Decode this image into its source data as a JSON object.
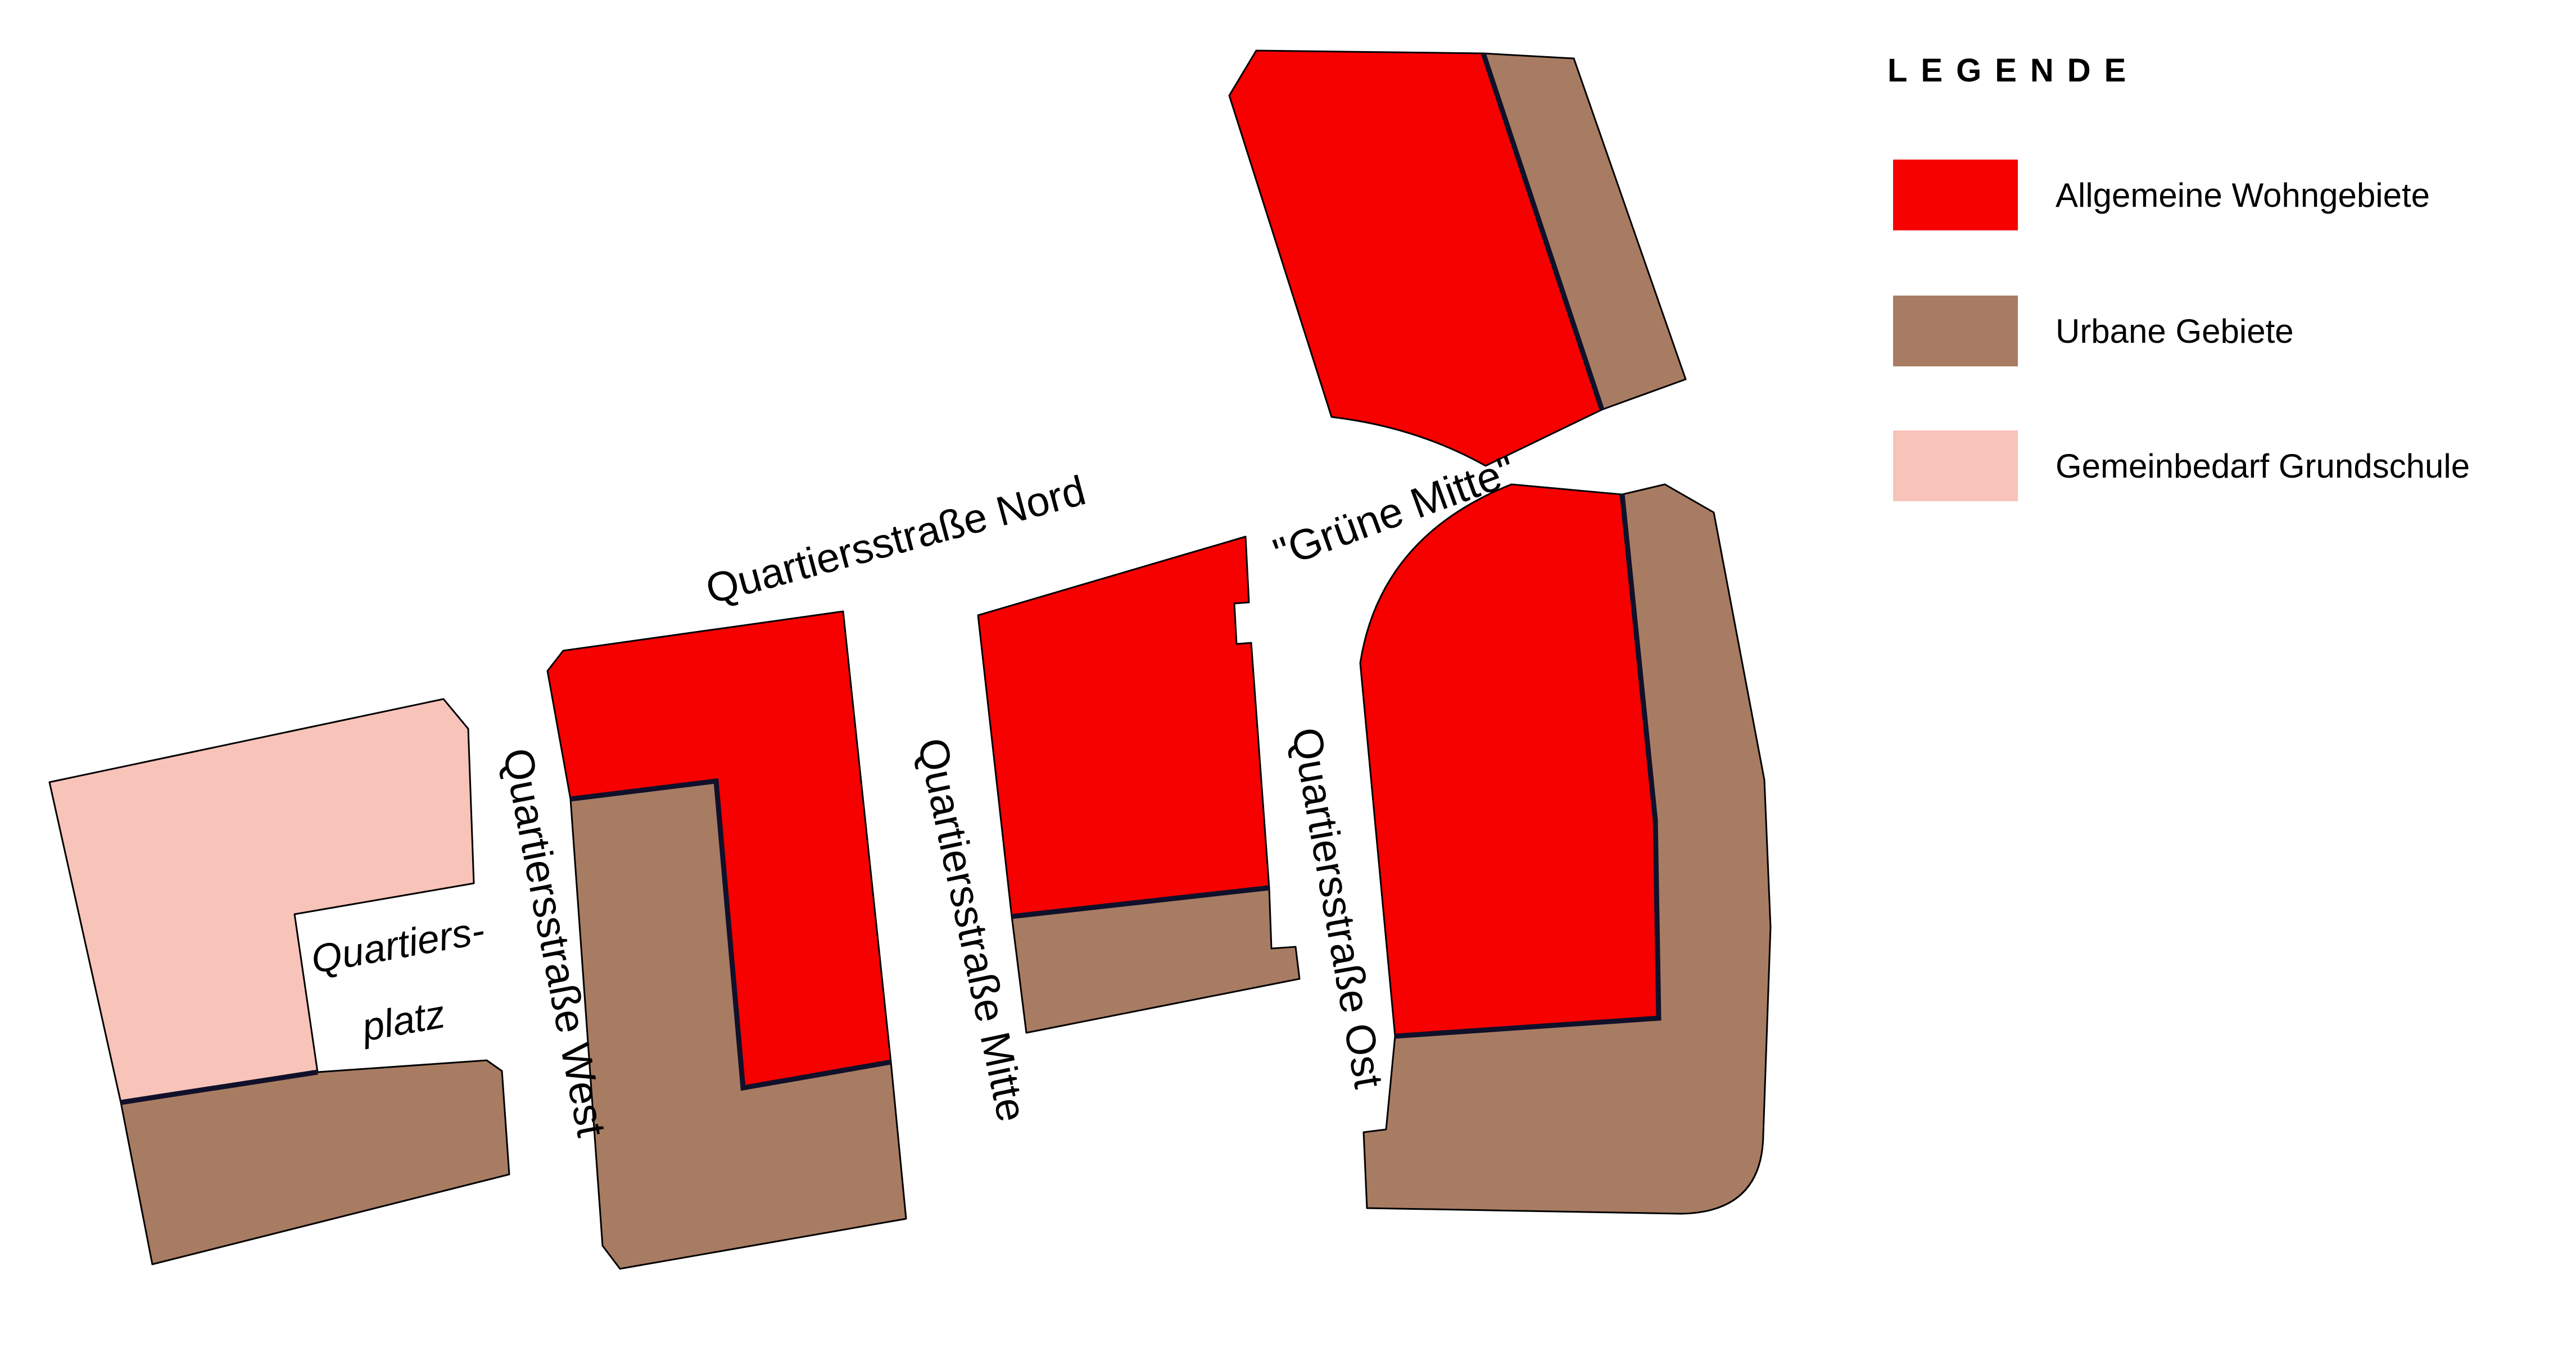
{
  "legend": {
    "title": "LEGENDE",
    "items": [
      {
        "label": "Allgemeine Wohngebiete",
        "color": "#f60000"
      },
      {
        "label": "Urbane Gebiete",
        "color": "#a87c63"
      },
      {
        "label": "Gemeinbedarf Grundschule",
        "color": "#f8c3b9"
      }
    ]
  },
  "map": {
    "labels": {
      "nord": "Quartiersstraße Nord",
      "west": "Quartiersstraße West",
      "mitte": "Quartiersstraße Mitte",
      "ost": "Quartiersstraße Ost",
      "gruene_mitte": "\"Grüne Mitte\"",
      "platz_line1": "Quartiers-",
      "platz_line2": "platz"
    }
  },
  "colors": {
    "residential": "#f60000",
    "urban": "#a87c63",
    "school": "#f8c3b9",
    "outline": "#000000",
    "divider": "#10102a",
    "background": "#ffffff",
    "label": "#000000"
  }
}
